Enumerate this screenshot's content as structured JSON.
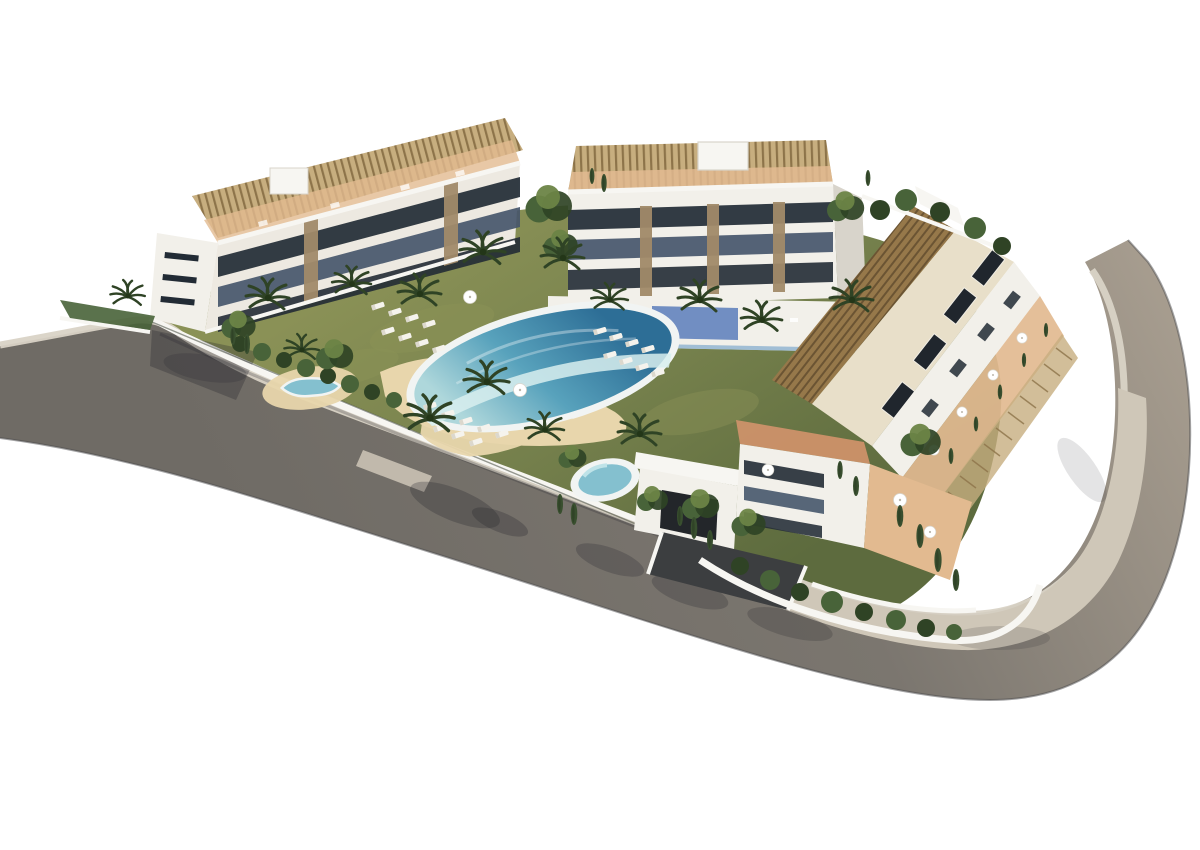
{
  "image": {
    "kind": "3d-architectural-render",
    "subject": "Aerial 3D rendering of a modern white residential apartment complex arranged around a landscaped communal courtyard with a lagoon-style infinity pool with beach entry, a circular spa pool and a small kidney-shaped pool, all ringed by a curving perimeter road with a light sidewalk, isolated on a plain white background",
    "visible_text": "none",
    "background_color": "#ffffff"
  },
  "palette": {
    "background": "#ffffff",
    "road_dark": "#6f6b65",
    "road_mid": "#7b766f",
    "road_light": "#a89e90",
    "road_edge": "#4a4a4c",
    "road_shadow": "#23232b",
    "sidewalk": "#cfc7b8",
    "curb": "#d9d3c6",
    "wall_white": "#f7f6f2",
    "building_white": "#f2f0ea",
    "building_shade": "#d8d4cb",
    "roof_cream": "#e8dfc9",
    "glass_dark": "#222b35",
    "glass_mid": "#46566b",
    "skylight": "#20262d",
    "stone": "#a18a69",
    "pergola_tan": "#c7ae7f",
    "pergola_tan_line": "#8d744a",
    "pergola_brown": "#96784a",
    "pergola_brown_line": "#6b5433",
    "terrace": "#d3946c",
    "terrace_light": "#e2ba90",
    "grass": "#75804c",
    "grass_dark": "#5d6b3e",
    "grass_light": "#8a9156",
    "foliage_dark": "#2f4325",
    "foliage_mid": "#486339",
    "foliage_light": "#6c8446",
    "cypress": "#394f2f",
    "sand": "#e8d6ac",
    "pool_deep": "#2d6e96",
    "pool_mid": "#58a2bc",
    "pool_aqua": "#aed7db",
    "pool_rim": "#f1f4f3",
    "cascade": "#d8eeee",
    "spa_water": "#84c0cf",
    "deck_blue": "#5a7cbb",
    "glass_blue": "#7fa8cc",
    "lounger": "#f5f3ed"
  },
  "scene": {
    "buildings": [
      {
        "id": "west-block",
        "description": "Four-storey white apartment block, dark glazed balcony bands, stone piers, rooftop terraces with slatted pergolas"
      },
      {
        "id": "north-block",
        "description": "Four-storey white block with rooftop pergolas and stair tower, raised pool deck with blue glass balustrade in front"
      },
      {
        "id": "east-block",
        "description": "Long stepped wing with brown slatted pergola roofs, cream roof deck with dark skylights, terracotta terraces facing the road"
      },
      {
        "id": "south-annex",
        "description": "Lower block with garage entrance ramp and terracotta corner terraces with parasols"
      }
    ],
    "amenities": [
      "lagoon-style infinity pool with beach entry",
      "circular spa pool",
      "kidney-shaped children's pool",
      "sun lounger clusters on lawns and beach",
      "white parasols",
      "palm trees and cypress hedges",
      "perimeter road with light sidewalk"
    ]
  }
}
